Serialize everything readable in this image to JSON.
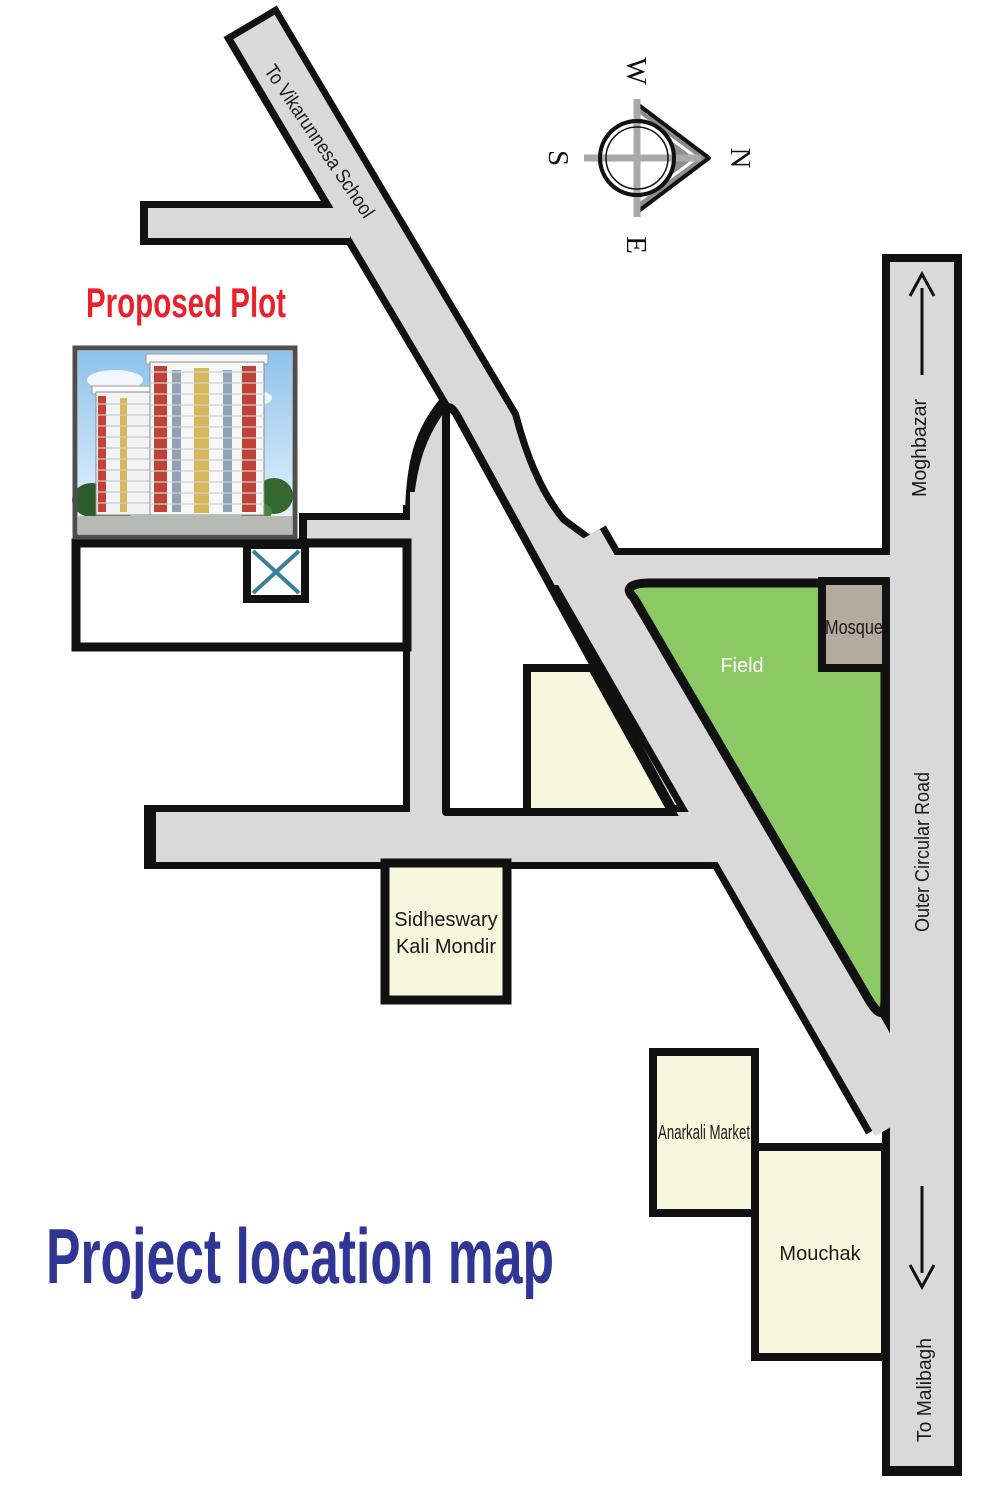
{
  "title": "Project location map",
  "proposed_plot_label": "Proposed Plot",
  "compass": {
    "north": "N",
    "south": "S",
    "east": "E",
    "west": "W"
  },
  "roads": {
    "vikarunnesa": "To Vikarunnesa School",
    "moghbazar": "Moghbazar",
    "outer_circular": "Outer Circular Road",
    "malibagh": "To Malibagh"
  },
  "places": {
    "field": "Field",
    "mosque": "Mosque",
    "sidheswary_line1": "Sidheswary",
    "sidheswary_line2": "Kali Mondir",
    "anarkali": "Anarkali Market",
    "mouchak": "Mouchak"
  },
  "colors": {
    "road_fill": "#d9d9d9",
    "outline_black": "#111111",
    "field_green": "#8cc863",
    "mosque_tan": "#b3ab9d",
    "block_cream": "#f8f6dd",
    "plot_marker_blue": "#3a7f9a",
    "proposed_plot_red": "#e8212d",
    "title_blue": "#2f3695"
  }
}
